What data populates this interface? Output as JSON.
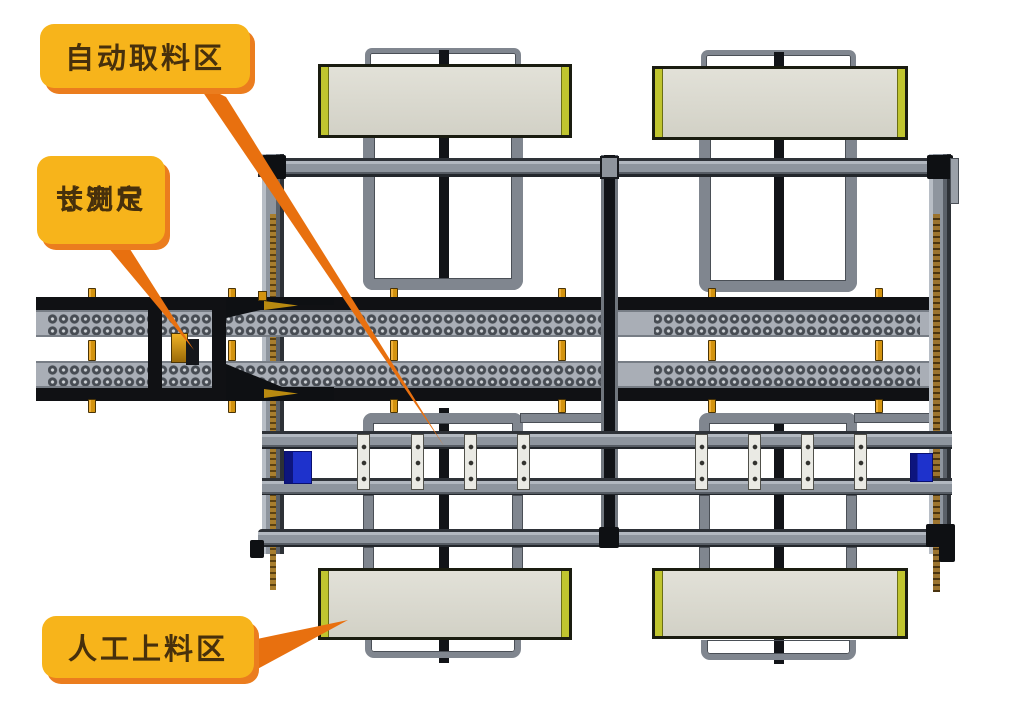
{
  "callouts": {
    "auto_pick": {
      "label": "自动取料区"
    },
    "dimension": {
      "label_line1": "长宽尺",
      "label_line2": "寸测定"
    },
    "manual_load": {
      "label": "人工上料区"
    }
  },
  "colors": {
    "callout_fill": "#F7B41B",
    "callout_shadow": "#EB7D1E",
    "callout_text": "#47300C",
    "leader_orange": "#E8700F",
    "rail_gray": "#8E959E",
    "frame_tube_gray": "#80868F",
    "frame_dark": "#121418",
    "belt_gray": "#A9AEB6",
    "pin_gold": "#D3930F",
    "panel_fill": "#DCDBD1",
    "panel_edge_green": "#C0C52F",
    "plate_white": "#EAEAE4",
    "actuator_blue": "#1E32CC",
    "chain_gold": "#A87E2E",
    "chain_brown": "#9C742F"
  }
}
